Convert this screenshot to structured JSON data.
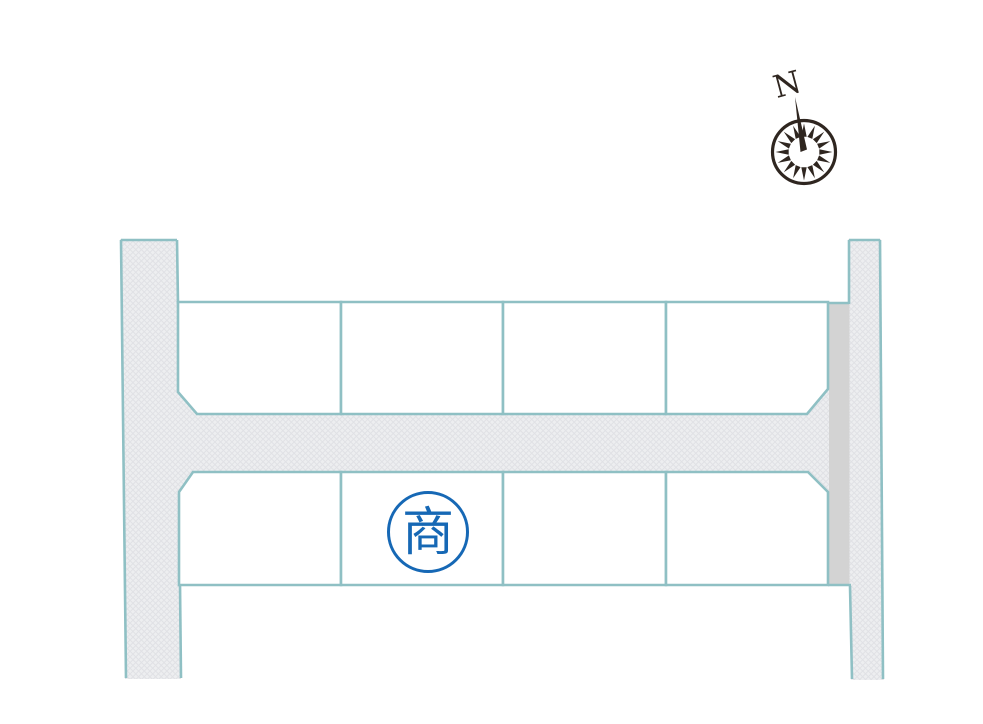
{
  "site_plan": {
    "compass": {
      "north_label": "N"
    },
    "featured_plot": {
      "tagline": "街なかモデルハウス",
      "name": "岐阜市須賀",
      "section_letter": "E",
      "section_suffix": "区画",
      "fill_color": "#F0990B",
      "text_color": "#FFFFFF"
    },
    "commercial_plot": {
      "mark": "商",
      "mark_color": "#1668B5"
    },
    "colors": {
      "road_border": "#8FC0C4",
      "road_fill": "#EDEEF0",
      "road_hatch_line": "#E0E1E5",
      "sidewalk_strip": "#D3D3D3",
      "compass_ink": "#2F2620",
      "background": "#FFFFFF"
    },
    "icons": {
      "compass": "compass-rose-icon",
      "needle": "north-needle-icon"
    }
  }
}
